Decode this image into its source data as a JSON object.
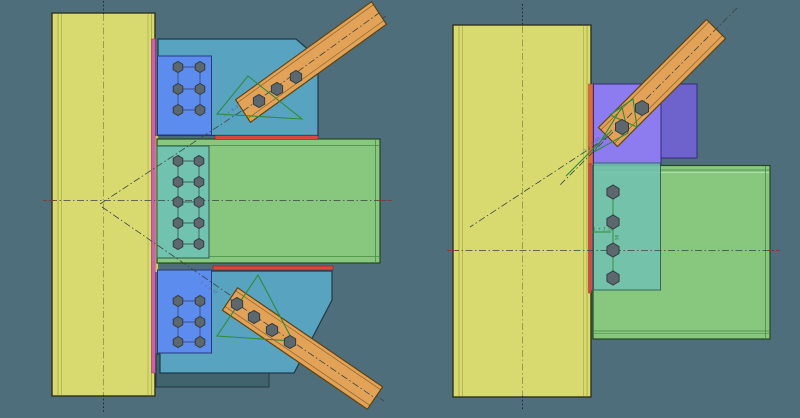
{
  "scene": {
    "description": "CAD viewport with two elevation views of a bolted steel beam-column-brace connection",
    "views": {
      "left_label": "connection-front-view",
      "right_label": "connection-side-view"
    }
  },
  "colors": {
    "background": "#4d6e7a",
    "column_fill": "#d8da70",
    "column_edge": "#33331a",
    "column_line": "#a8ac48",
    "column_centerline": "#8b8e44",
    "beam_fill": "#87c77e",
    "beam_edge": "#23471f",
    "beam_line": "#468a46",
    "gusset_fill": "#58a4c0",
    "gusset_edge": "#1f3a46",
    "plate_blue_fill": "#5c8cee",
    "plate_blue_edge": "#28397f",
    "plate_teal_fill": "#72c2b0",
    "plate_teal_edge": "#2a5a52",
    "plate_purple_fill": "#8d7cf0",
    "plate_purple_back": "#6e63cc",
    "plate_purple_edge": "#352a80",
    "brace_fill": "#e2a258",
    "brace_edge": "#5f430f",
    "weld_red": "#d9483f",
    "weld_red_edge": "#7a1f1a",
    "weld_magenta": "#d060a8",
    "weld_orange": "#e06a3a",
    "weld_green": "#2e8b3a",
    "bolt_fill": "#5c686e",
    "bolt_edge": "#333c40",
    "centerline": "#3c4446",
    "centerline_red": "#8b3a35",
    "dim_blue": "#5a6a9f",
    "dim_green": "#2e7d32",
    "shadow_teal": "#40636e"
  },
  "dimensions": {
    "left_top_brace": "1 + 8.97",
    "left_bottom_brace": "1 + 8.97",
    "right_brace": "1 + 0.60",
    "right_bolt_spacing": "1 + 2.50",
    "right_bolt_pitch": "50"
  },
  "bolt_groups": [
    {
      "name": "left-top-plate-bolts",
      "grid": {
        "xs": [
          178,
          200
        ],
        "ys": [
          67,
          89,
          110
        ]
      },
      "r": 5.5,
      "connector": "#3f4c80"
    },
    {
      "name": "left-middle-plate-bolts",
      "grid": {
        "xs": [
          178,
          199
        ],
        "ys": [
          161,
          182,
          202,
          223,
          244
        ]
      },
      "r": 5.5,
      "connector": "#3d5c55"
    },
    {
      "name": "left-bottom-plate-bolts",
      "grid": {
        "xs": [
          178,
          200
        ],
        "ys": [
          301,
          322,
          342
        ]
      },
      "r": 5.5,
      "connector": "#3f4c80"
    },
    {
      "name": "left-top-brace-bolts",
      "pts": [
        [
          259,
          101
        ],
        [
          277,
          89
        ],
        [
          296,
          77
        ]
      ],
      "r": 6.5
    },
    {
      "name": "left-bottom-brace-bolts",
      "pts": [
        [
          237,
          304
        ],
        [
          254,
          317
        ],
        [
          272,
          330
        ],
        [
          290,
          342
        ]
      ],
      "r": 6.5
    },
    {
      "name": "right-plate-bolts",
      "grid": {
        "xs": [
          613
        ],
        "ys": [
          192,
          222,
          250,
          278
        ]
      },
      "r": 7,
      "connector": "#2e8b3a"
    },
    {
      "name": "right-brace-bolts",
      "pts": [
        [
          622,
          127
        ],
        [
          642,
          108
        ]
      ],
      "r": 7.5
    }
  ]
}
